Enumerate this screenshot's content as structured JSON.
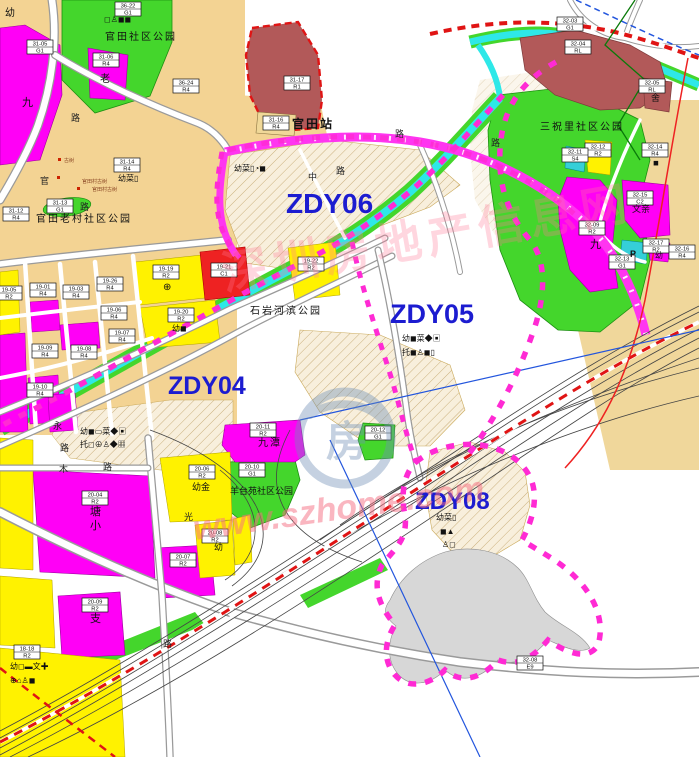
{
  "map": {
    "colors": {
      "tan": "#f3d393",
      "cream": "#f8efdc",
      "yellow": "#fff200",
      "magenta": "#ff00f6",
      "park_green": "#44d62c",
      "maroon": "#b25959",
      "red_block": "#ee2222",
      "cyan_river": "#2ee8e8",
      "gray_area": "#d7d7d7",
      "boundary_pink": "#ff2ad4",
      "road_magenta": "#ff35f0",
      "rail_red": "#e01414",
      "zdy_blue": "#1c1cd0"
    },
    "zdy_labels": [
      {
        "text": "ZDY06",
        "x": 286,
        "y": 213,
        "size": 28
      },
      {
        "text": "ZDY05",
        "x": 390,
        "y": 323,
        "size": 27
      },
      {
        "text": "ZDY04",
        "x": 168,
        "y": 394,
        "size": 25
      },
      {
        "text": "ZDY08",
        "x": 415,
        "y": 509,
        "size": 24
      }
    ],
    "parcels": [
      {
        "code": "36-22",
        "zone": "G1",
        "x": 128,
        "y": 9
      },
      {
        "code": "31-05",
        "zone": "G1",
        "x": 40,
        "y": 47
      },
      {
        "code": "31-06",
        "zone": "R4",
        "x": 106,
        "y": 60
      },
      {
        "code": "31-17",
        "zone": "R1",
        "x": 297,
        "y": 83
      },
      {
        "code": "36-24",
        "zone": "R4",
        "x": 186,
        "y": 86
      },
      {
        "code": "31-16",
        "zone": "R4",
        "x": 276,
        "y": 123
      },
      {
        "code": "31-14",
        "zone": "R4",
        "x": 127,
        "y": 165
      },
      {
        "code": "31-13",
        "zone": "G1",
        "x": 60,
        "y": 206
      },
      {
        "code": "31-12",
        "zone": "R4",
        "x": 16,
        "y": 214
      },
      {
        "code": "19-05",
        "zone": "R2",
        "x": 9,
        "y": 293
      },
      {
        "code": "19-01",
        "zone": "R4",
        "x": 43,
        "y": 290
      },
      {
        "code": "19-03",
        "zone": "R4",
        "x": 76,
        "y": 292
      },
      {
        "code": "19-26",
        "zone": "R4",
        "x": 110,
        "y": 284
      },
      {
        "code": "19-19",
        "zone": "R2",
        "x": 166,
        "y": 272
      },
      {
        "code": "19-20",
        "zone": "R2",
        "x": 181,
        "y": 315
      },
      {
        "code": "19-06",
        "zone": "R4",
        "x": 114,
        "y": 313
      },
      {
        "code": "19-07",
        "zone": "R4",
        "x": 122,
        "y": 336
      },
      {
        "code": "19-08",
        "zone": "R4",
        "x": 84,
        "y": 352
      },
      {
        "code": "19-09",
        "zone": "R4",
        "x": 45,
        "y": 351
      },
      {
        "code": "19-10",
        "zone": "R4",
        "x": 40,
        "y": 390
      },
      {
        "code": "19-21",
        "zone": "C1",
        "x": 224,
        "y": 270
      },
      {
        "code": "19-22",
        "zone": "R2",
        "x": 311,
        "y": 264
      },
      {
        "code": "20-06",
        "zone": "R2",
        "x": 202,
        "y": 472
      },
      {
        "code": "20-08",
        "zone": "R2",
        "x": 215,
        "y": 536
      },
      {
        "code": "20-11",
        "zone": "R2",
        "x": 263,
        "y": 430
      },
      {
        "code": "20-10",
        "zone": "G1",
        "x": 252,
        "y": 470
      },
      {
        "code": "20-12",
        "zone": "G1",
        "x": 378,
        "y": 433
      },
      {
        "code": "20-04",
        "zone": "R2",
        "x": 95,
        "y": 498
      },
      {
        "code": "20-07",
        "zone": "R2",
        "x": 183,
        "y": 560
      },
      {
        "code": "20-09",
        "zone": "R2",
        "x": 95,
        "y": 605
      },
      {
        "code": "18-18",
        "zone": "R2",
        "x": 27,
        "y": 652
      },
      {
        "code": "32-03",
        "zone": "G1",
        "x": 570,
        "y": 24
      },
      {
        "code": "32-04",
        "zone": "RL",
        "x": 578,
        "y": 47
      },
      {
        "code": "32-05",
        "zone": "RL",
        "x": 652,
        "y": 86
      },
      {
        "code": "32-12",
        "zone": "R2",
        "x": 598,
        "y": 150
      },
      {
        "code": "32-11",
        "zone": "S4",
        "x": 575,
        "y": 155
      },
      {
        "code": "32-14",
        "zone": "R4",
        "x": 655,
        "y": 150
      },
      {
        "code": "32-15",
        "zone": "C2",
        "x": 640,
        "y": 198
      },
      {
        "code": "32-09",
        "zone": "R2",
        "x": 592,
        "y": 228
      },
      {
        "code": "32-13",
        "zone": "G1",
        "x": 622,
        "y": 262
      },
      {
        "code": "32-17",
        "zone": "R2",
        "x": 656,
        "y": 246
      },
      {
        "code": "32-16",
        "zone": "R4",
        "x": 682,
        "y": 252
      },
      {
        "code": "32-08",
        "zone": "E9",
        "x": 530,
        "y": 663
      }
    ],
    "places": [
      {
        "text": "官田社区公园",
        "x": 105,
        "y": 40,
        "size": 10,
        "color": "#111"
      },
      {
        "text": "官田站",
        "x": 292,
        "y": 128,
        "size": 12,
        "color": "#111",
        "bold": true
      },
      {
        "text": "官田老村社区公园",
        "x": 36,
        "y": 222,
        "size": 10,
        "color": "#111"
      },
      {
        "text": "三祝里社区公园",
        "x": 540,
        "y": 130,
        "size": 10,
        "color": "#111"
      },
      {
        "text": "石岩河滨公园",
        "x": 250,
        "y": 314,
        "size": 10,
        "color": "#111"
      },
      {
        "text": "羊台苑社区公园",
        "x": 230,
        "y": 494,
        "size": 9,
        "color": "#111"
      },
      {
        "text": "九潭",
        "x": 258,
        "y": 446,
        "size": 10,
        "color": "#111"
      },
      {
        "text": "九",
        "x": 590,
        "y": 248,
        "size": 11,
        "color": "#111"
      },
      {
        "text": "九",
        "x": 22,
        "y": 106,
        "size": 11,
        "color": "#111"
      },
      {
        "text": "老",
        "x": 100,
        "y": 82,
        "size": 10,
        "color": "#111"
      },
      {
        "text": "舍",
        "x": 651,
        "y": 101,
        "size": 9,
        "color": "#111"
      },
      {
        "text": "文亲",
        "x": 632,
        "y": 212,
        "size": 9,
        "color": "#111"
      },
      {
        "text": "塘",
        "x": 90,
        "y": 515,
        "size": 11,
        "color": "#111"
      },
      {
        "text": "小",
        "x": 90,
        "y": 529,
        "size": 11,
        "color": "#111"
      },
      {
        "text": "支",
        "x": 90,
        "y": 622,
        "size": 11,
        "color": "#111"
      },
      {
        "text": "幼",
        "x": 5,
        "y": 16,
        "size": 10,
        "color": "#111"
      },
      {
        "text": "幼金",
        "x": 192,
        "y": 490,
        "size": 9,
        "color": "#111"
      },
      {
        "text": "幼",
        "x": 214,
        "y": 550,
        "size": 9,
        "color": "#111"
      },
      {
        "text": "幼",
        "x": 655,
        "y": 258,
        "size": 8,
        "color": "#111"
      },
      {
        "text": "P",
        "x": 630,
        "y": 257,
        "size": 9,
        "color": "#111",
        "bold": true
      },
      {
        "text": "古树",
        "x": 64,
        "y": 162,
        "size": 5,
        "color": "#884422"
      },
      {
        "text": "官田村古树",
        "x": 82,
        "y": 183,
        "size": 5,
        "color": "#884422"
      },
      {
        "text": "官田村古树",
        "x": 92,
        "y": 191,
        "size": 5,
        "color": "#884422"
      }
    ],
    "road_chars": [
      {
        "text": "官",
        "x": 40,
        "y": 184,
        "size": 9
      },
      {
        "text": "路",
        "x": 71,
        "y": 121,
        "size": 9
      },
      {
        "text": "路",
        "x": 80,
        "y": 210,
        "size": 9
      },
      {
        "text": "中",
        "x": 308,
        "y": 180,
        "size": 9
      },
      {
        "text": "路",
        "x": 336,
        "y": 174,
        "size": 9
      },
      {
        "text": "路",
        "x": 395,
        "y": 137,
        "size": 9
      },
      {
        "text": "路",
        "x": 491,
        "y": 146,
        "size": 9
      },
      {
        "text": "木",
        "x": 59,
        "y": 472,
        "size": 9
      },
      {
        "text": "路",
        "x": 103,
        "y": 470,
        "size": 9
      },
      {
        "text": "光",
        "x": 184,
        "y": 520,
        "size": 9
      },
      {
        "text": "永",
        "x": 53,
        "y": 429,
        "size": 9
      },
      {
        "text": "路",
        "x": 60,
        "y": 451,
        "size": 9
      },
      {
        "text": "路",
        "x": 163,
        "y": 647,
        "size": 9
      }
    ],
    "icon_rows": [
      {
        "text": "◻♙◼◼",
        "x": 104,
        "y": 22,
        "size": 8
      },
      {
        "text": "幼菜▯",
        "x": 118,
        "y": 181,
        "size": 8
      },
      {
        "text": "幼菜▯◔◼",
        "x": 234,
        "y": 171,
        "size": 8
      },
      {
        "text": "幼◼菜◆▣",
        "x": 402,
        "y": 341,
        "size": 8
      },
      {
        "text": "托◼♙◼▯",
        "x": 402,
        "y": 355,
        "size": 8
      },
      {
        "text": "幼◼▭菜◆▣",
        "x": 80,
        "y": 434,
        "size": 8
      },
      {
        "text": "托◻⊕♙◆▦",
        "x": 80,
        "y": 447,
        "size": 8
      },
      {
        "text": "幼菜▯",
        "x": 436,
        "y": 520,
        "size": 8
      },
      {
        "text": "◼▲",
        "x": 440,
        "y": 534,
        "size": 8
      },
      {
        "text": "♙◻",
        "x": 442,
        "y": 547,
        "size": 8
      },
      {
        "text": "幼◼",
        "x": 172,
        "y": 331,
        "size": 8
      },
      {
        "text": "⊕",
        "x": 163,
        "y": 290,
        "size": 10
      },
      {
        "text": "◼",
        "x": 653,
        "y": 165,
        "size": 7
      },
      {
        "text": "幼◻▬文✚",
        "x": 10,
        "y": 669,
        "size": 8
      },
      {
        "text": "⊕⌂♙◼",
        "x": 10,
        "y": 683,
        "size": 8
      }
    ],
    "markers": [
      {
        "x": 58,
        "y": 158
      },
      {
        "x": 57,
        "y": 176
      },
      {
        "x": 77,
        "y": 187
      }
    ],
    "watermark": {
      "brand": "深圳房地产信息网",
      "url": "www.szhome.com",
      "logo_char": "房"
    }
  }
}
